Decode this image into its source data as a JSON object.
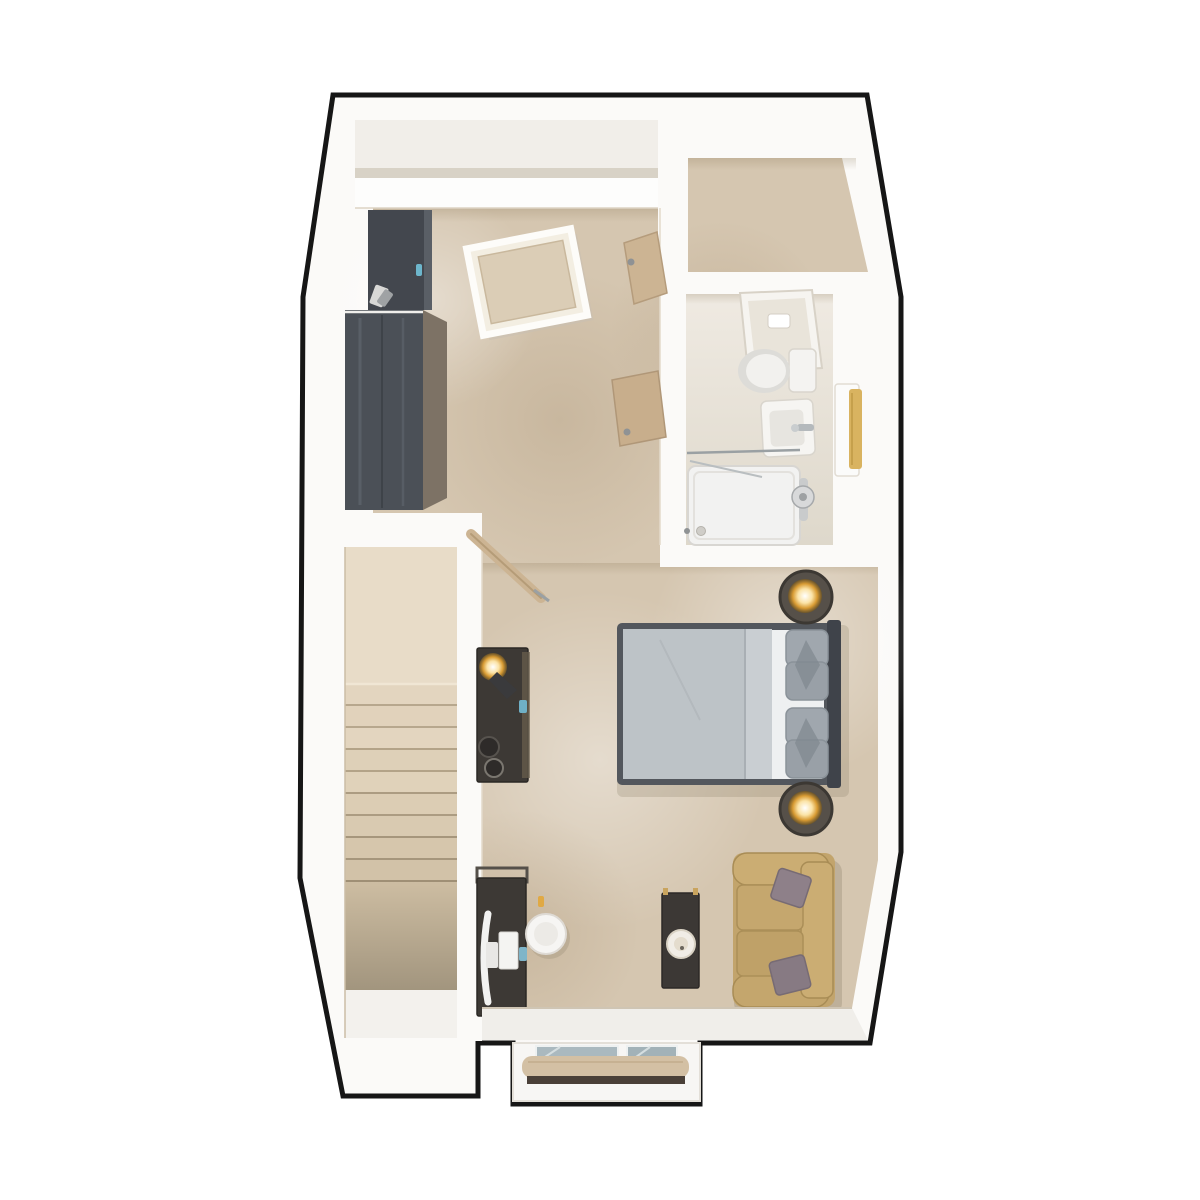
{
  "scene": {
    "type": "3d-floor-plan-top-view",
    "description": "Top-down 3D architectural render of a studio loft apartment",
    "rooms": [
      {
        "name": "main-studio-room",
        "floor": "beige-carpet"
      },
      {
        "name": "dressing-area",
        "floor": "beige-carpet"
      },
      {
        "name": "bathroom",
        "floor": "light-tile"
      },
      {
        "name": "stair-landing",
        "floor": "beige-carpet"
      },
      {
        "name": "staircase",
        "floor": "carpeted-steps"
      },
      {
        "name": "entrance-bay",
        "floor": "white"
      }
    ],
    "furniture": [
      "tall-wardrobe-cabinet",
      "wide-wardrobe",
      "loft-hatch-skylight",
      "stair-handrail",
      "console-with-reading-lamp",
      "double-bed",
      "bedside-table-with-lamp",
      "bedside-table-with-lamp",
      "desk-with-monitor-and-keyboard",
      "round-desk-chair",
      "narrow-console-table-with-bowl",
      "two-seat-sofa-with-cushions",
      "toilet-with-cistern",
      "tilted-mirror-cabinet",
      "washbasin-with-tap",
      "towel-radiator",
      "walk-in-shower",
      "sloped-ceiling-planks",
      "entrance-glass-door-bay"
    ]
  },
  "colors": {
    "outline": "#161616",
    "wall": "#fbfaf8",
    "wall_face": "#f1eee9",
    "carpet": "#d5c6b0",
    "carpet_light": "#e7dcc9",
    "carpet_shade": "#c3b29a",
    "bathroom_floor": "#e9e4da",
    "stairs_landing": "#e8dcc8",
    "stair_tread": "#e3d5bf",
    "stair_dark": "#b4a489",
    "wood_dark_front": "#4b5057",
    "wood_dark_side": "#7d7265",
    "furniture_dark": "#3d3935",
    "oak": "#ccb493",
    "sofa": "#c2a46c",
    "sofa_cushion": "#8e8089",
    "bed_frame": "#53575d",
    "bed_duvet": "#bdc3c7",
    "bed_fold": "#c9ced2",
    "bed_sheet": "#eef0f1",
    "bed_pillow": "#a0a7ae",
    "lamp_gold": "#e0a944",
    "glass": "#aab9bf",
    "towel_gold": "#d9b360",
    "chrome": "#b4b9bc",
    "entry_roll": "#d3c0a4",
    "entry_floor": "#f0eeea"
  }
}
